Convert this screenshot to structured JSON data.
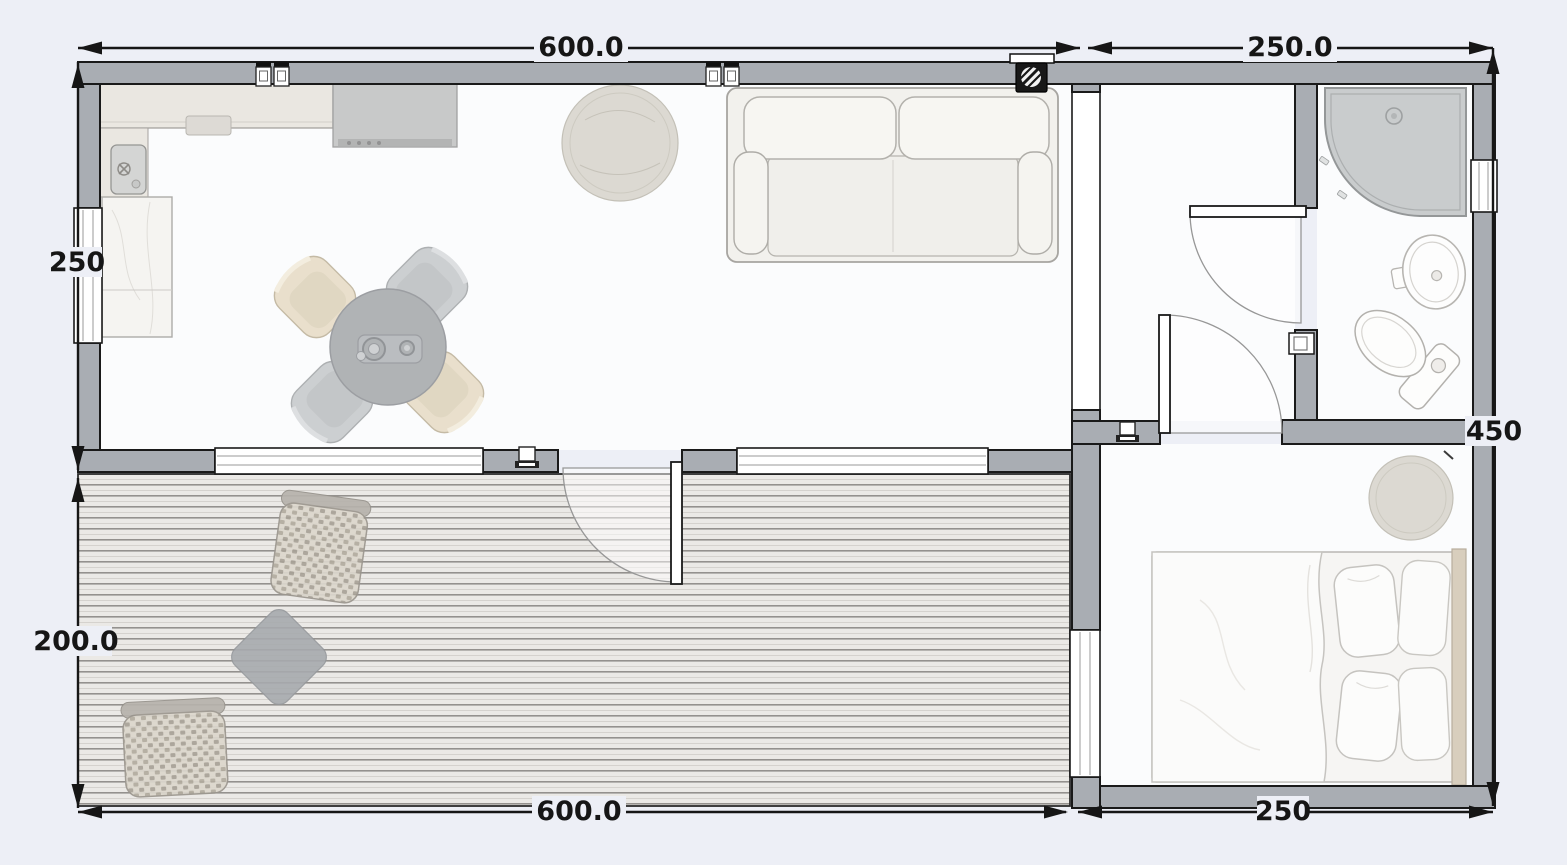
{
  "floorplan": {
    "dimensions": {
      "top_main": "600.0",
      "top_right": "250.0",
      "left_upper": "250",
      "left_lower": "200.0",
      "bottom_main": "600.0",
      "bottom_right": "250",
      "right_side": "450"
    },
    "colors": {
      "background": "#edeff6",
      "wall_fill": "#a9adb3",
      "outline": "#1a1a1a",
      "floor": "#fbfcfd",
      "deck_base": "#ebe9e6",
      "dimension_text": "#161616",
      "furniture_gray": "#a6a9ac",
      "furniture_beige": "#e7dcc6"
    },
    "rooms": [
      "kitchen-living-room",
      "hallway",
      "bathroom",
      "bedroom",
      "deck"
    ],
    "symbols": {
      "power_outlet": "duplex power outlet",
      "light_switch": "light switch",
      "electrical_panel": "electrical panel",
      "window": "window",
      "door_swing": "door with swing arc"
    },
    "fixtures": [
      "kitchen-counter",
      "kitchen-sink",
      "cooktop",
      "tall-cabinet",
      "dining-table",
      "dining-chairs",
      "round-rug",
      "sofa",
      "corner-shower",
      "washbasin",
      "toilet",
      "double-bed",
      "pillows",
      "bedroom-rug",
      "wicker-chairs",
      "deck-side-table"
    ]
  }
}
